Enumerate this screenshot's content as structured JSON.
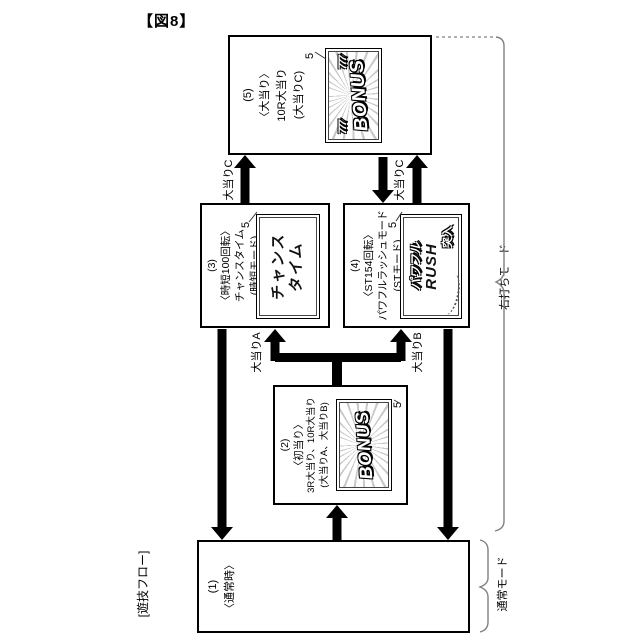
{
  "figure_label": "【図8】",
  "boxes": {
    "b5": {
      "num": "(5)",
      "line1": "〈大当り〉",
      "line2": "10R大当り",
      "line3": "(大当りC)",
      "screen_ref": "5",
      "screen": {
        "sevens": "777",
        "title": "BONUS"
      }
    },
    "b3": {
      "num": "(3)",
      "line1": "〈時短100回転〉",
      "line2": "チャンスタイム",
      "line3": "(時短モード)",
      "screen_ref": "5",
      "screen": {
        "line1": "チャンス",
        "line2": "タイム"
      }
    },
    "b4": {
      "num": "(4)",
      "line1": "〈ST154回転〉",
      "line2": "パワフルラッシュモード",
      "line3": "(STモード)",
      "screen_ref": "5",
      "screen": {
        "line1": "パワフル",
        "line2": "RUSH",
        "line3": "突入"
      }
    },
    "b2": {
      "num": "(2)",
      "line1": "〈初当り〉",
      "line2": "3R大当り、10R大当り",
      "line3": "(大当りA、大当りB)",
      "screen_ref": "5",
      "screen": {
        "title": "BONUS"
      }
    },
    "b1": {
      "num": "(1)",
      "line1": "〈通常時〉"
    }
  },
  "arrow_labels": {
    "c_left": "大当りC",
    "c_right": "大当りC",
    "a": "大当りA",
    "b": "大当りB"
  },
  "side_labels": {
    "flow": "[遊技フロー]",
    "right_mode": "右打ちモード",
    "normal_mode": "通常モード"
  },
  "colors": {
    "line": "#000000",
    "brace": "#808080"
  }
}
